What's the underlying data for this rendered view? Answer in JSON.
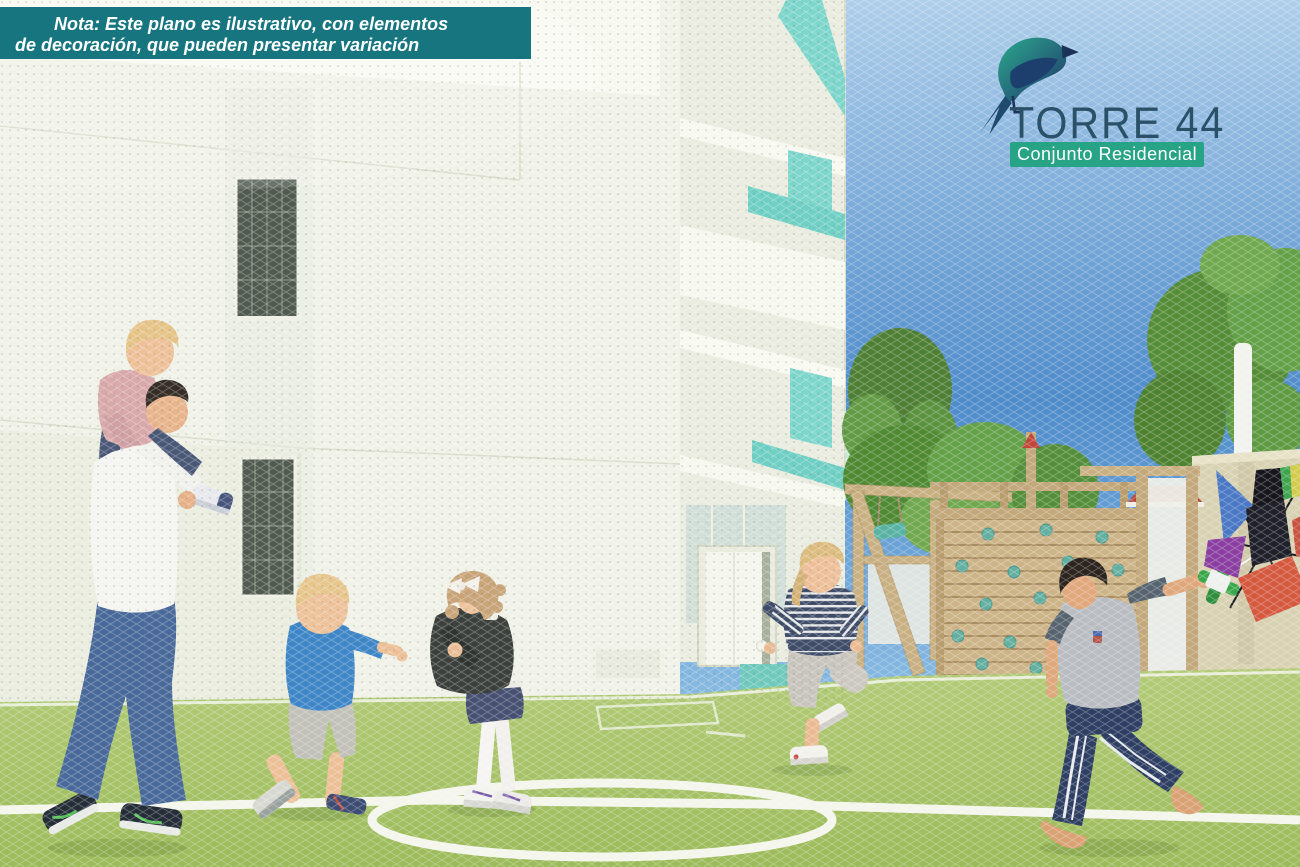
{
  "note_banner": {
    "line1": "Nota: Este plano es ilustrativo, con elementos",
    "line2": "de decoración, que pueden presentar variación"
  },
  "logo": {
    "title": "TORRE 44",
    "subtitle": "Conjunto Residencial"
  },
  "palette": {
    "banner_teal": "#16757f",
    "logo_title_color": "#2b5168",
    "logo_badge_green": "#27a385",
    "accent_teal": "#7dd6cb",
    "sky_top": "#aeceea",
    "sky_deep": "#4e8bca",
    "sky_horizon": "#8fc0e4",
    "grass_light": "#b3cb78",
    "grass_deep": "#9cbb5a",
    "wood": "#cdb488",
    "wall_beige": "#d8d1b2",
    "building_white": "#f0f2e8"
  }
}
